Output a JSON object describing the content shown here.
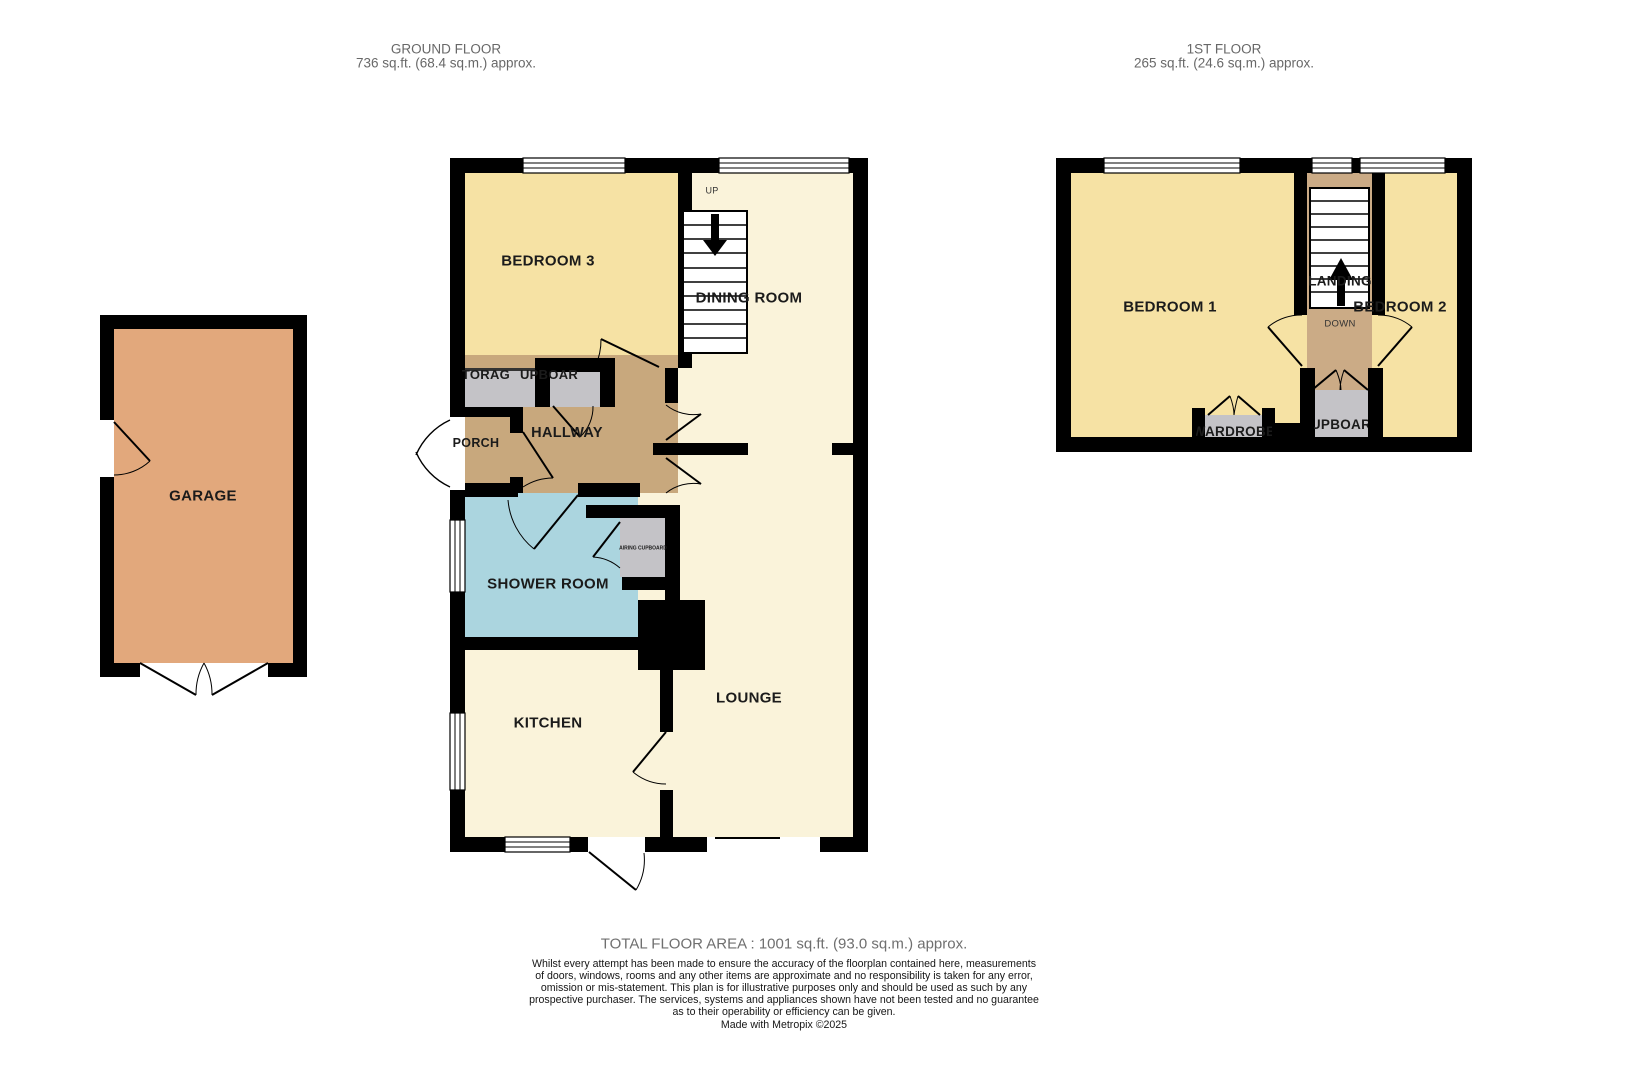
{
  "header": {
    "ground_floor": {
      "title": "GROUND FLOOR",
      "area": "736 sq.ft. (68.4 sq.m.) approx."
    },
    "first_floor": {
      "title": "1ST FLOOR",
      "area": "265 sq.ft. (24.6 sq.m.) approx."
    }
  },
  "garage": {
    "label": "GARAGE"
  },
  "ground_floor": {
    "rooms": {
      "bedroom3": "BEDROOM 3",
      "dining": "DINING ROOM",
      "up": "UP",
      "storage": "STORAGE",
      "cupboard": "CUPBOARD",
      "hallway": "HALLWAY",
      "porch": "PORCH",
      "shower": "SHOWER ROOM",
      "airing": "AIRING CUPBOARD",
      "kitchen": "KITCHEN",
      "lounge": "LOUNGE"
    }
  },
  "first_floor": {
    "rooms": {
      "bedroom1": "BEDROOM 1",
      "bedroom2": "BEDROOM 2",
      "landing": "LANDING",
      "down": "DOWN",
      "wardrobe": "WARDROBE",
      "cupboard": "CUPBOARD"
    }
  },
  "footer": {
    "total": "TOTAL FLOOR AREA : 1001 sq.ft. (93.0 sq.m.) approx.",
    "disclaimer_lines": [
      "Whilst every attempt has been made to ensure the accuracy of the floorplan contained here, measurements",
      "of doors, windows, rooms and any other items are approximate and no responsibility is taken for any error,",
      "omission or mis-statement. This plan is for illustrative purposes only and should be used as such by any",
      "prospective purchaser. The services, systems and appliances shown have not been tested and no guarantee",
      "as to their operability or efficiency can be given.",
      "Made with Metropix ©2025"
    ]
  },
  "palette": {
    "bedroom_yellow": "#f6e2a4",
    "living_cream": "#faf3da",
    "hall_brown": "#c8a87d",
    "shower_blue": "#abd5df",
    "cupboard_grey": "#c4c3c7",
    "garage_orange": "#e2a87c",
    "landing_tan": "#cbab86",
    "wall_black": "#000000"
  }
}
